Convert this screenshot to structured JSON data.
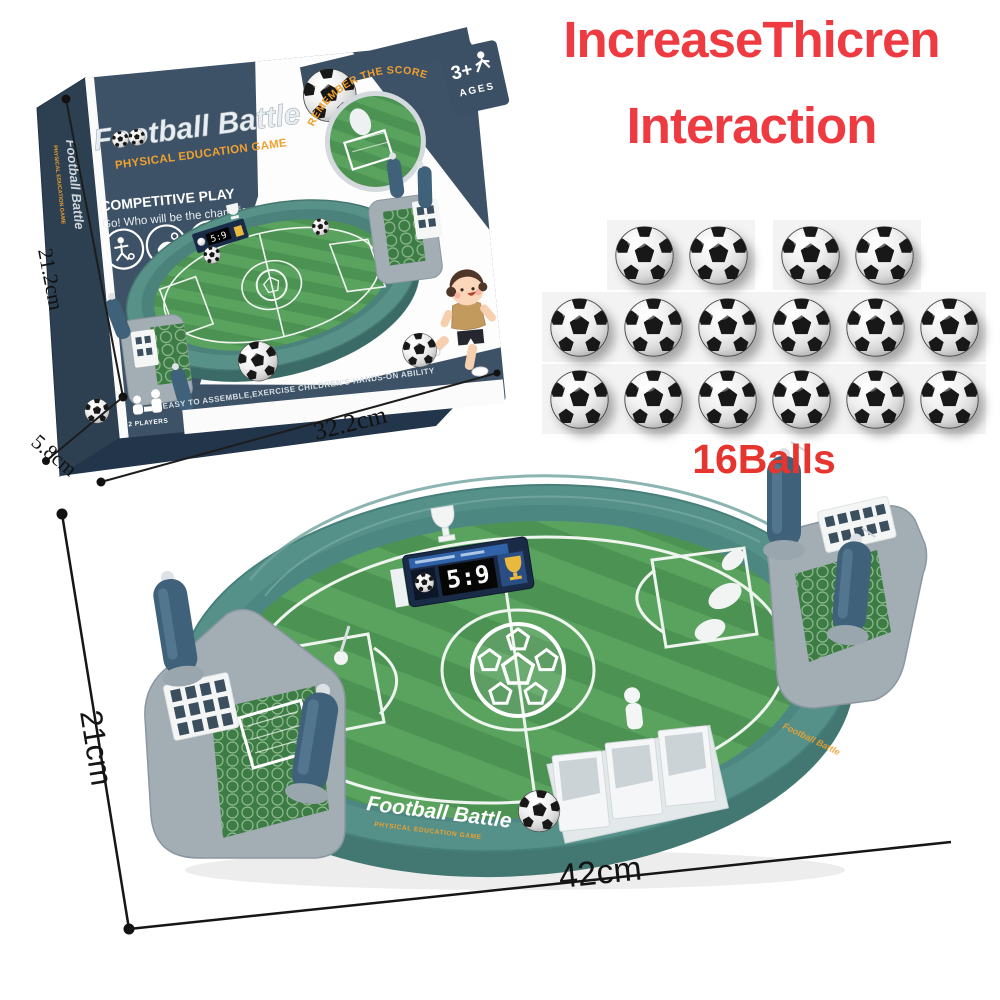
{
  "heading": {
    "line1": "IncreaseThicren",
    "line2": "Interaction",
    "color": "#ee3a41"
  },
  "balls": {
    "label": "16Balls",
    "count": 16,
    "row_groups": [
      [
        2,
        2
      ],
      [
        6
      ],
      [
        6
      ]
    ]
  },
  "box": {
    "title": "Football Battle",
    "subtitle": "PHYSICAL EDUCATION GAME",
    "competitive": "COMPETITIVE PLAY",
    "tagline": "Go! Who will be the champion?",
    "remember": "REMEMBER THE SCORE",
    "ages_number": "3+",
    "ages_label": "AGES",
    "players_label": "2 PLAYERS",
    "bottom_note": "EASY TO ASSEMBLE,EXERCISE CHILDREN'S HANDS-ON ABILITY",
    "dims": {
      "height": "21.2cm",
      "depth": "5.8cm",
      "width": "32.2cm"
    },
    "colors": {
      "face": "#3d5266",
      "side": "#2c4052",
      "orange": "#f0a12f"
    }
  },
  "board": {
    "score": "5:9",
    "brand": "Football Battle",
    "brand_sub": "PHYSICAL EDUCATION GAME",
    "dims": {
      "height": "21cm",
      "width": "42cm"
    },
    "colors": {
      "rim": "#559189",
      "field_dark": "#4c9253",
      "field_light": "#5aa35f",
      "platform": "#a2adb4",
      "handle": "#40617a"
    }
  }
}
